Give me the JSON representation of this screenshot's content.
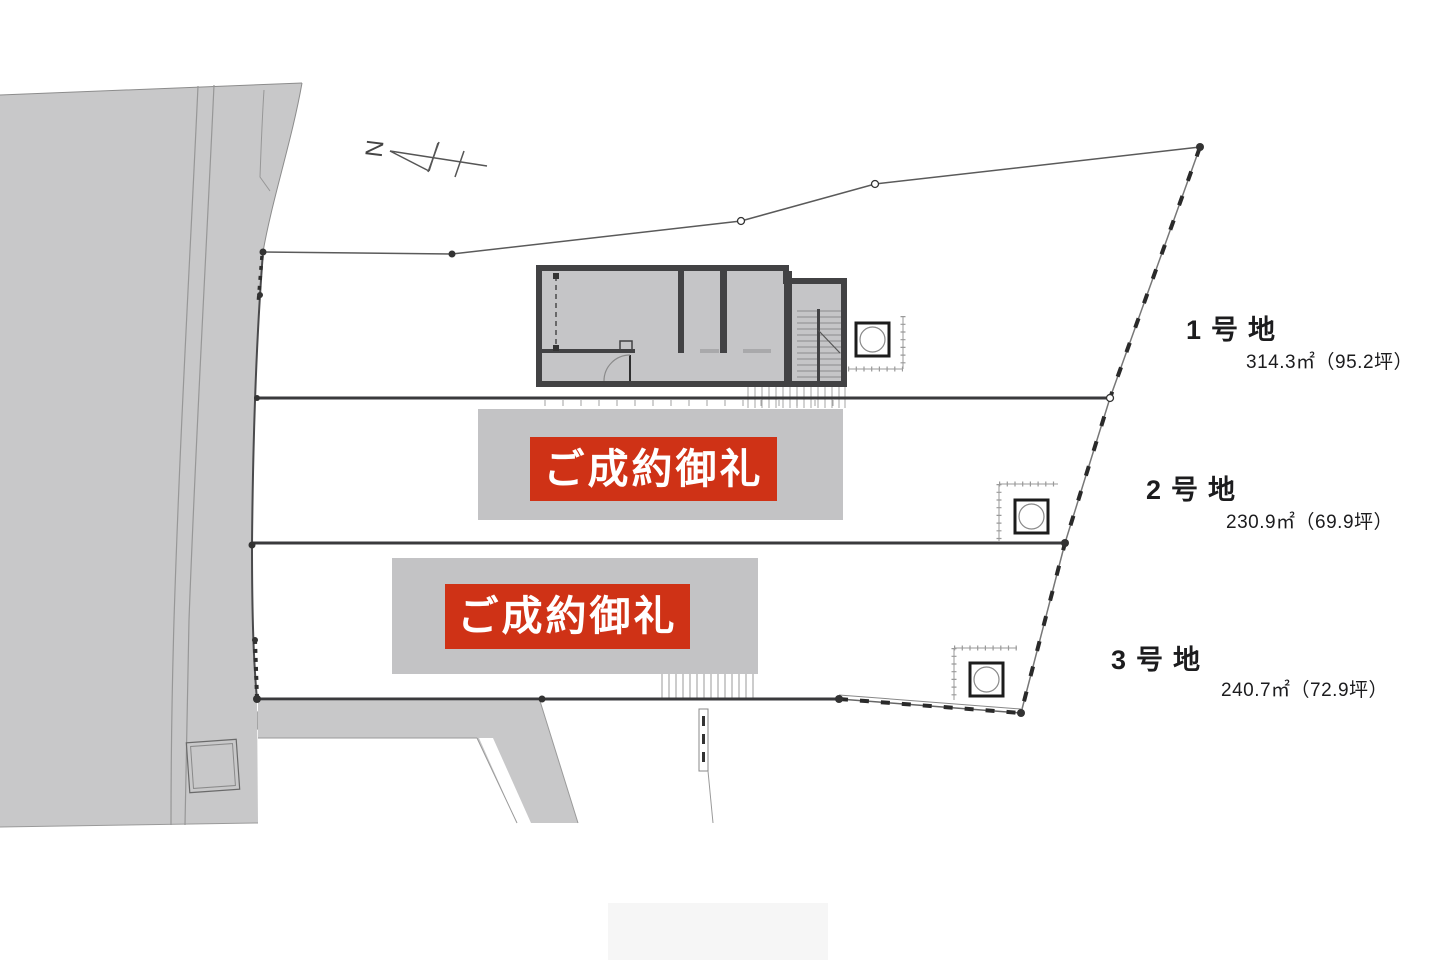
{
  "compass": {
    "label": "N"
  },
  "lots": [
    {
      "name": "1号地",
      "area": "314.3㎡（95.2坪）"
    },
    {
      "name": "2号地",
      "area": "230.9㎡（69.9坪）",
      "banner": "ご成約御礼"
    },
    {
      "name": "3号地",
      "area": "240.7㎡（72.9坪）",
      "banner": "ご成約御礼"
    }
  ],
  "colors": {
    "banner_red": "#cf3216",
    "banner_backdrop": "#c3c3c5",
    "road_gray": "#c8c8c9",
    "wall_dark": "#424244",
    "text_ink": "#1c1c1e"
  }
}
